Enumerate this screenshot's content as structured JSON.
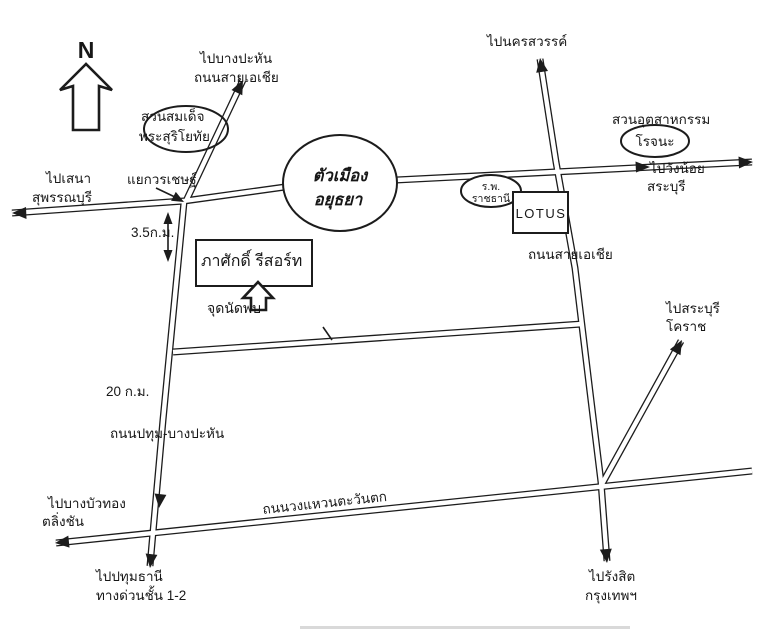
{
  "compass": {
    "label": "N"
  },
  "city": {
    "line1": "ตัวเมือง",
    "line2": "อยุธยา"
  },
  "junction": {
    "label": "แยกวรเชษฐ์"
  },
  "landmarks": {
    "suriyothai_park": {
      "line1": "สวนสมเด็จ",
      "line2": "พระสุริโยทัย"
    },
    "hospital": {
      "line1": "ร.พ.",
      "line2": "ราชธานี"
    },
    "lotus": {
      "label": "LOTUS"
    },
    "industrial_park": {
      "line1": "สวนอุตสาหกรรม",
      "line2": "โรจนะ"
    },
    "resort": {
      "label": "ภาศักดิ์ รีสอร์ท"
    },
    "meeting_point": {
      "label": "จุดนัดพบ"
    }
  },
  "roads": {
    "asia_top": {
      "line1": "ไปบางปะหัน",
      "line2": "ถนนสายเอเชีย"
    },
    "asia_right": {
      "label": "ถนนสายเอเชีย"
    },
    "pathum_bang_pahan": {
      "label": "ถนนปทุม-บางปะหัน"
    },
    "ring_road": {
      "label": "ถนนวงแหวนตะวันตก"
    }
  },
  "destinations": {
    "nakhon_sawan": {
      "label": "ไปนครสวรรค์"
    },
    "sena": {
      "line1": "ไปเสนา",
      "line2": "สุพรรณบุรี"
    },
    "wang_noi": {
      "line1": "ไปวังน้อย",
      "line2": "สระบุรี"
    },
    "saraburi_korat": {
      "line1": "ไปสระบุรี",
      "line2": "โคราช"
    },
    "bang_bua_thong": {
      "line1": "ไปบางบัวทอง",
      "line2": "ตลิ่งชัน"
    },
    "pathum_thani": {
      "line1": "ไปปทุมธานี",
      "line2": "ทางด่วนชั้น 1-2"
    },
    "rangsit": {
      "line1": "ไปรังสิต",
      "line2": "กรุงเทพฯ"
    }
  },
  "distances": {
    "junction_to_resort": "3.5ก.ม.",
    "junction_to_ring": "20 ก.ม."
  },
  "colors": {
    "ink": "#1c1c1c",
    "paper": "#ffffff"
  }
}
